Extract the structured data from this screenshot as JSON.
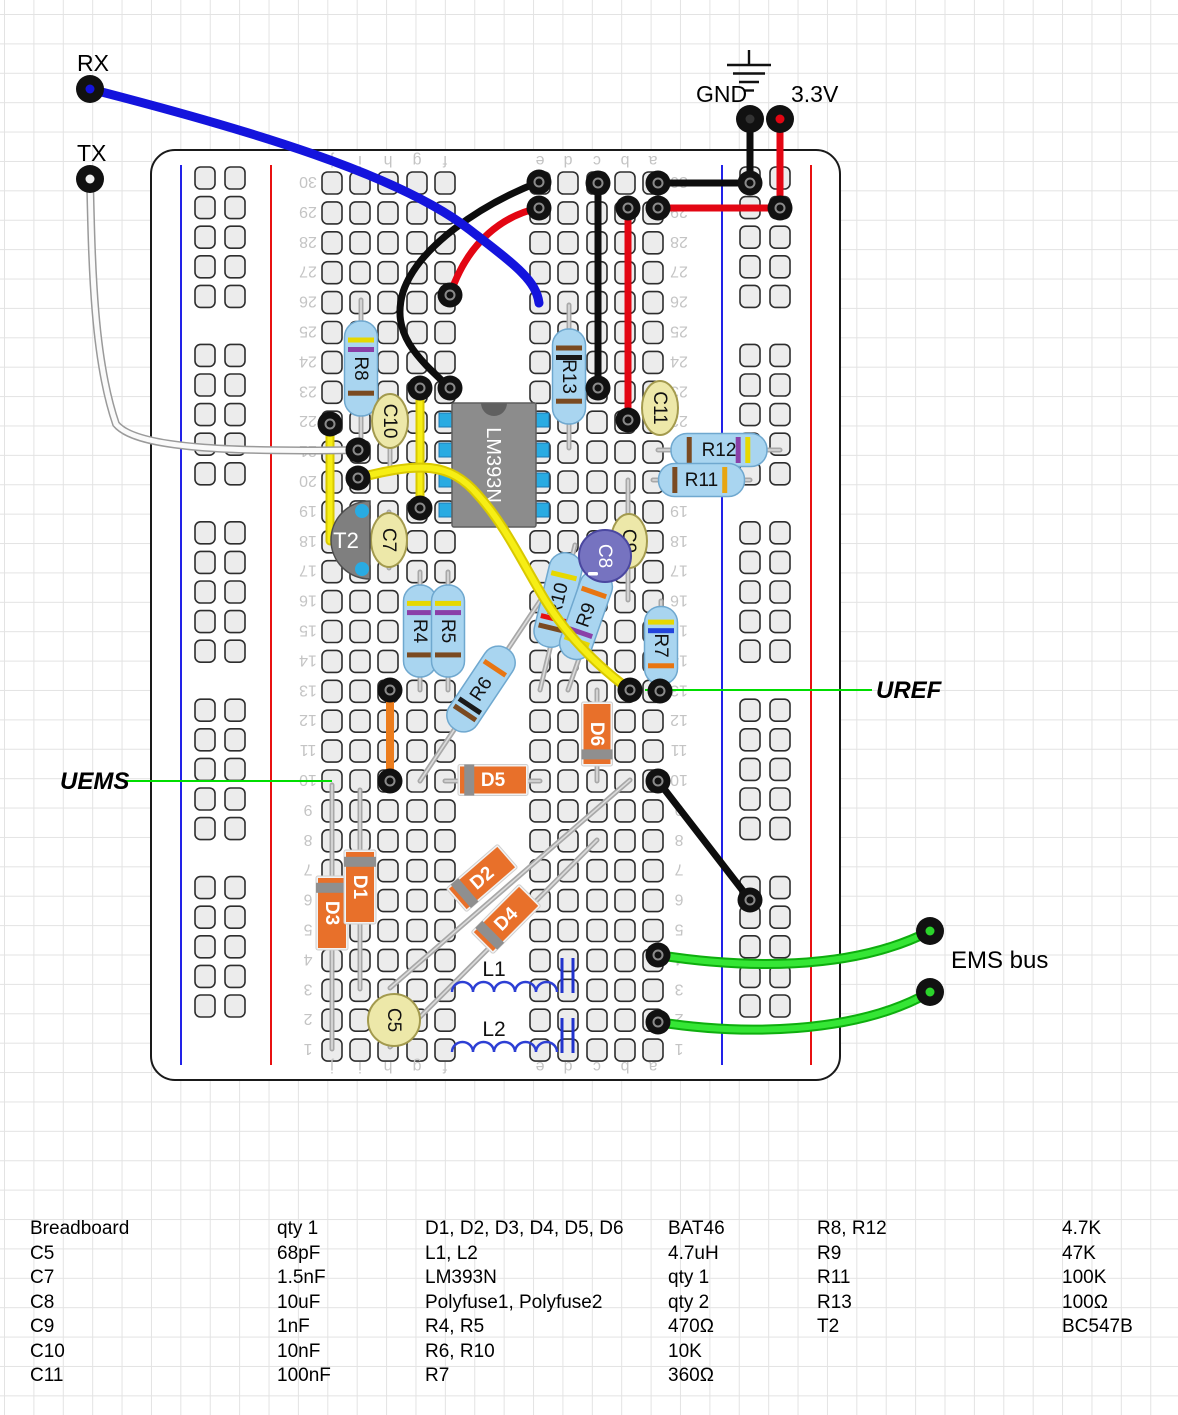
{
  "canvas": {
    "w": 1178,
    "h": 1415
  },
  "labels": {
    "rx": "RX",
    "tx": "TX",
    "gnd": "GND",
    "v33": "3.3V",
    "uref": "UREF",
    "uems": "UEMS",
    "ems_bus": "EMS bus"
  },
  "board": {
    "x": 151,
    "y": 150,
    "w": 689,
    "h": 930,
    "row_count": 30,
    "row0_y": 183,
    "row_pitch": 29.9,
    "cols_left": {
      "letters": [
        "j",
        "i",
        "h",
        "g",
        "f"
      ],
      "x": [
        332,
        360,
        388,
        417,
        445
      ]
    },
    "cols_right": {
      "letters": [
        "e",
        "d",
        "c",
        "b",
        "a"
      ],
      "x": [
        540,
        568,
        597,
        625,
        653
      ]
    },
    "rails": {
      "left": {
        "blue_x": 181,
        "red_x": 271,
        "hole_x": [
          205,
          235
        ]
      },
      "right": {
        "blue_x": 722,
        "red_x": 811,
        "hole_x": [
          750,
          780
        ]
      },
      "line_y1": 165,
      "line_y2": 1065,
      "group_y0": 178,
      "group_pitch": 177.4,
      "hole_pitch": 29.6,
      "holes_per_group": 5,
      "groups": 5
    },
    "num_x_left": 308,
    "num_x_right": 679,
    "letters_y_top": 162,
    "letters_y_bottom": 1068,
    "hole_fill": "#ececec",
    "hole_stroke": "#2e2e2e",
    "rail_blue": "#2222e8",
    "rail_red": "#e81111"
  },
  "callouts": [
    {
      "name": "uems-callout",
      "x1": 123,
      "y1": 781,
      "x2": 332,
      "y2": 781,
      "color": "#00dd00"
    },
    {
      "name": "uref-callout",
      "x1": 645,
      "y1": 690,
      "x2": 872,
      "y2": 690,
      "color": "#00dd00"
    }
  ],
  "components": [
    {
      "id": "D3",
      "type": "diode",
      "label": "D3",
      "a": [
        332,
        785
      ],
      "b": [
        332,
        1049
      ],
      "body": [
        332,
        913
      ],
      "len": 70,
      "wid": 28,
      "band_f": -0.36
    },
    {
      "id": "D1",
      "type": "diode",
      "label": "D1",
      "a": [
        360,
        790
      ],
      "b": [
        360,
        989
      ],
      "body": [
        360,
        887
      ],
      "len": 70,
      "wid": 28,
      "band_f": -0.36
    },
    {
      "id": "D2",
      "type": "diode",
      "label": "D2",
      "a": [
        390,
        988
      ],
      "b": [
        630,
        780
      ],
      "body": [
        482,
        878
      ],
      "len": 64,
      "wid": 27,
      "band_f": -0.36
    },
    {
      "id": "D4",
      "type": "diode",
      "label": "D4",
      "a": [
        390,
        1047
      ],
      "b": [
        597,
        840
      ],
      "body": [
        506,
        919
      ],
      "len": 64,
      "wid": 27,
      "band_f": -0.36
    },
    {
      "id": "C5",
      "type": "cap_round",
      "label": "C5",
      "c": [
        394,
        1020
      ],
      "r": 26,
      "fill": "#EDE8A9",
      "stroke": "#A39A4E",
      "text": "#111"
    },
    {
      "id": "L1",
      "type": "inductor",
      "label": "L1",
      "x1": 452,
      "y": 992,
      "bumps": 5,
      "bump_w": 21,
      "label_pos": [
        494,
        976
      ]
    },
    {
      "id": "L2",
      "type": "inductor",
      "label": "L2",
      "x1": 452,
      "y": 1052,
      "bumps": 5,
      "bump_w": 21,
      "label_pos": [
        494,
        1036
      ]
    },
    {
      "id": "Polyfuse1",
      "type": "polyfuse",
      "x": [
        562,
        573
      ],
      "y1": 958,
      "y2": 993
    },
    {
      "id": "Polyfuse2",
      "type": "polyfuse",
      "x": [
        562,
        573
      ],
      "y1": 1018,
      "y2": 1053
    },
    {
      "id": "D5",
      "type": "diode",
      "label": "D5",
      "a": [
        445,
        781
      ],
      "b": [
        540,
        781
      ],
      "body": [
        493,
        780
      ],
      "len": 66,
      "wid": 27,
      "band_f": -0.36
    },
    {
      "id": "D6",
      "type": "diode",
      "label": "D6",
      "a": [
        597,
        690
      ],
      "b": [
        597,
        781
      ],
      "body": [
        597,
        734
      ],
      "len": 60,
      "wid": 27,
      "band_f": 0.34
    },
    {
      "id": "R8",
      "type": "resistor",
      "label": "R8",
      "a": [
        361,
        300
      ],
      "b": [
        361,
        437
      ],
      "body_len": 95,
      "bands": [
        [
          "#e6d800",
          -0.3
        ],
        [
          "#8a3fa8",
          -0.2
        ],
        [
          "#7a4a21",
          0.26
        ]
      ]
    },
    {
      "id": "R13",
      "type": "resistor",
      "label": "R13",
      "a": [
        569,
        305
      ],
      "b": [
        569,
        448
      ],
      "body_len": 95,
      "bands": [
        [
          "#7a4a21",
          -0.3
        ],
        [
          "#1a1a1a",
          -0.2
        ],
        [
          "#7a4a21",
          0.26
        ]
      ]
    },
    {
      "id": "R4",
      "type": "resistor",
      "label": "R4",
      "a": [
        420,
        572
      ],
      "b": [
        420,
        690
      ],
      "body_len": 92,
      "bands": [
        [
          "#e6d800",
          -0.3
        ],
        [
          "#8a3fa8",
          -0.2
        ],
        [
          "#7a4a21",
          0.26
        ]
      ]
    },
    {
      "id": "R5",
      "type": "resistor",
      "label": "R5",
      "a": [
        448,
        572
      ],
      "b": [
        448,
        690
      ],
      "body_len": 92,
      "bands": [
        [
          "#e6d800",
          -0.3
        ],
        [
          "#8a3fa8",
          -0.2
        ],
        [
          "#7a4a21",
          0.26
        ]
      ]
    },
    {
      "id": "R6",
      "type": "resistor",
      "label": "R6",
      "a": [
        420,
        781
      ],
      "b": [
        540,
        601
      ],
      "body_c": [
        481,
        689
      ],
      "body_len": 96,
      "bands": [
        [
          "#7a4a21",
          -0.3
        ],
        [
          "#1a1a1a",
          -0.21
        ],
        [
          "#e87511",
          0.26
        ]
      ]
    },
    {
      "id": "R10",
      "type": "resistor",
      "label": "R10",
      "a": [
        540,
        690
      ],
      "b": [
        575,
        545
      ],
      "body_c": [
        558,
        600
      ],
      "body_len": 96,
      "bands": [
        [
          "#7a4a21",
          -0.3
        ],
        [
          "#e81111",
          -0.2
        ],
        [
          "#e6d800",
          0.26
        ]
      ]
    },
    {
      "id": "R9",
      "type": "resistor",
      "label": "R9",
      "a": [
        568,
        690
      ],
      "b": [
        610,
        570
      ],
      "body_c": [
        586,
        615
      ],
      "body_len": 92,
      "bands": [
        [
          "#e6d800",
          -0.3
        ],
        [
          "#8a3fa8",
          -0.2
        ],
        [
          "#e87511",
          0.26
        ]
      ]
    },
    {
      "id": "R7",
      "type": "resistor",
      "label": "R7",
      "a": [
        661,
        601
      ],
      "b": [
        661,
        690
      ],
      "body_len": 78,
      "bands": [
        [
          "#e6d800",
          -0.3
        ],
        [
          "#2244dd",
          -0.19
        ],
        [
          "#e87511",
          0.26
        ]
      ]
    },
    {
      "id": "R12",
      "type": "resistor",
      "label": "R12",
      "a": [
        658,
        450
      ],
      "b": [
        780,
        450
      ],
      "body_len": 96,
      "bands": [
        [
          "#7a4a21",
          -0.31
        ],
        [
          "#8a3fa8",
          0.2
        ],
        [
          "#e6d800",
          0.3
        ]
      ]
    },
    {
      "id": "R11",
      "type": "resistor",
      "label": "R11",
      "a": [
        653,
        480
      ],
      "b": [
        750,
        480
      ],
      "body_len": 86,
      "bands": [
        [
          "#7a4a21",
          -0.31
        ],
        [
          "#e8a511",
          0.27
        ]
      ]
    },
    {
      "id": "C10",
      "type": "cap_ellipse",
      "label": "C10",
      "c": [
        390,
        421
      ],
      "lead": [
        390,
        400,
        390,
        472
      ]
    },
    {
      "id": "C7",
      "type": "cap_ellipse",
      "label": "C7",
      "c": [
        389,
        540
      ],
      "lead": [
        389,
        512,
        389,
        568
      ]
    },
    {
      "id": "C9",
      "type": "cap_ellipse",
      "label": "C9",
      "c": [
        629,
        541
      ],
      "lead": [
        628,
        480,
        628,
        600
      ]
    },
    {
      "id": "C11",
      "type": "cap_ellipse",
      "label": "C11",
      "c": [
        660,
        408
      ],
      "lead": [
        660,
        388,
        660,
        430
      ]
    },
    {
      "id": "T2",
      "type": "transistor",
      "label": "T2",
      "cx": 352,
      "cy": 540,
      "r": 39,
      "pins": [
        [
          362,
          511
        ],
        [
          362,
          569
        ]
      ]
    },
    {
      "id": "C8",
      "type": "cap_round",
      "label": "C8",
      "c": [
        605,
        556
      ],
      "r": 26,
      "fill": "#7673c0",
      "stroke": "#4a47a0",
      "text": "#fff",
      "minus": true
    },
    {
      "id": "IC1",
      "type": "ic",
      "label": "LM393N",
      "x": 452,
      "y": 403,
      "w": 84,
      "h": 124,
      "pad_rows": [
        420,
        450,
        480,
        510
      ],
      "pad_lx": 448,
      "pad_rx": 540
    }
  ],
  "under_wires": [
    {
      "name": "yellow-jumper-left",
      "colors": [
        "#d9c900",
        "#f6ee15"
      ],
      "widths": [
        9,
        5
      ],
      "path": "M330,424 L330,541"
    }
  ],
  "wires": [
    {
      "name": "red-curve-top",
      "colors": [
        "#e30613"
      ],
      "widths": [
        7
      ],
      "path": "M539,208 C505,215 468,240 450,295"
    },
    {
      "name": "black-curve-top",
      "colors": [
        "#0d0d0d"
      ],
      "widths": [
        7
      ],
      "path": "M539,182 C480,205 418,247 403,292 C391,333 416,357 450,388"
    },
    {
      "name": "rx-wire-blue",
      "colors": [
        "#1414dd"
      ],
      "widths": [
        9
      ],
      "path": "M90,89 C250,130 400,175 470,230 C515,265 536,280 539,303"
    },
    {
      "name": "tx-wire-white",
      "colors": [
        "#9a9a9a",
        "#fafafa"
      ],
      "widths": [
        8,
        5
      ],
      "path": "M90,179 C92,270 94,360 116,424 C136,449 235,452 358,450"
    },
    {
      "name": "gnd-stub",
      "colors": [
        "#0d0d0d"
      ],
      "widths": [
        7
      ],
      "path": "M750,118 L750,183"
    },
    {
      "name": "v33-stub",
      "colors": [
        "#e30613"
      ],
      "widths": [
        7
      ],
      "path": "M780,118 L780,208"
    },
    {
      "name": "row30-black",
      "colors": [
        "#0d0d0d"
      ],
      "widths": [
        7
      ],
      "path": "M658,183 L750,183"
    },
    {
      "name": "row29-red",
      "colors": [
        "#e30613"
      ],
      "widths": [
        7
      ],
      "path": "M658,208 L780,208"
    },
    {
      "name": "vertical-black",
      "colors": [
        "#0d0d0d"
      ],
      "widths": [
        7
      ],
      "path": "M598,183 L598,388"
    },
    {
      "name": "vertical-red",
      "colors": [
        "#e30613"
      ],
      "widths": [
        7
      ],
      "path": "M628,208 L628,420"
    },
    {
      "name": "yellow-jumper-mid",
      "colors": [
        "#d9c900",
        "#f6ee15"
      ],
      "widths": [
        9,
        5
      ],
      "path": "M420,388 L420,508"
    },
    {
      "name": "orange-jumper",
      "colors": [
        "#ec7d1d"
      ],
      "widths": [
        8
      ],
      "path": "M390,690 L390,781"
    },
    {
      "name": "yellow-long",
      "colors": [
        "#d9c900",
        "#f6ee15"
      ],
      "widths": [
        10,
        6
      ],
      "path": "M358,478 C420,462 450,462 478,495 C505,525 522,562 545,600 C570,640 600,668 630,690"
    },
    {
      "name": "black-diagonal",
      "colors": [
        "#0d0d0d"
      ],
      "widths": [
        7
      ],
      "path": "M658,781 L750,900"
    },
    {
      "name": "ems-wire-1",
      "colors": [
        "#0eae0e",
        "#35e635"
      ],
      "widths": [
        10,
        6
      ],
      "path": "M658,955 C740,968 850,972 930,931"
    },
    {
      "name": "ems-wire-2",
      "colors": [
        "#0eae0e",
        "#35e635"
      ],
      "widths": [
        10,
        6
      ],
      "path": "M658,1022 C740,1035 855,1035 930,992"
    }
  ],
  "dots": [
    [
      539,
      182
    ],
    [
      539,
      208
    ],
    [
      450,
      295
    ],
    [
      450,
      388
    ],
    [
      420,
      388
    ],
    [
      420,
      508
    ],
    [
      330,
      424
    ],
    [
      358,
      450
    ],
    [
      358,
      478
    ],
    [
      598,
      183
    ],
    [
      598,
      388
    ],
    [
      628,
      208
    ],
    [
      628,
      420
    ],
    [
      658,
      183
    ],
    [
      658,
      208
    ],
    [
      750,
      183
    ],
    [
      780,
      208
    ],
    [
      390,
      690
    ],
    [
      390,
      781
    ],
    [
      630,
      690
    ],
    [
      660,
      691
    ],
    [
      658,
      781
    ],
    [
      750,
      900
    ],
    [
      658,
      955
    ],
    [
      658,
      1022
    ]
  ],
  "pins": [
    {
      "name": "rx-pin",
      "x": 90,
      "y": 89,
      "core": "#1414dd"
    },
    {
      "name": "tx-pin",
      "x": 90,
      "y": 179,
      "core": "#f0f0f0"
    },
    {
      "name": "gnd-pin",
      "x": 750,
      "y": 119,
      "core": "#333333"
    },
    {
      "name": "v33-pin",
      "x": 780,
      "y": 119,
      "core": "#e30613"
    },
    {
      "name": "ems-pin-1",
      "x": 930,
      "y": 931,
      "core": "#2bd42b"
    },
    {
      "name": "ems-pin-2",
      "x": 930,
      "y": 992,
      "core": "#2bd42b"
    }
  ],
  "gnd_symbol": {
    "stem": [
      749,
      50,
      749,
      65
    ],
    "lines": [
      [
        727,
        65,
        771,
        65
      ],
      [
        733,
        73.5,
        765,
        73.5
      ],
      [
        739,
        82,
        759,
        82
      ],
      [
        744,
        90.5,
        754,
        90.5
      ]
    ]
  },
  "parts_table": {
    "col_x": [
      30,
      277,
      425,
      668,
      817,
      1062
    ],
    "row_top0": 1218,
    "row_pitch": 24.5,
    "rows": [
      [
        "Breadboard",
        "qty 1",
        "D1, D2, D3, D4, D5, D6",
        "BAT46",
        "R8, R12",
        "4.7K"
      ],
      [
        "C5",
        "68pF",
        "L1, L2",
        "4.7uH",
        "R9",
        "47K"
      ],
      [
        "C7",
        "1.5nF",
        "LM393N",
        "qty 1",
        "R11",
        "100K"
      ],
      [
        "C8",
        "10uF",
        "Polyfuse1, Polyfuse2",
        "qty 2",
        "R13",
        "100Ω"
      ],
      [
        "C9",
        "1nF",
        "R4, R5",
        "470Ω",
        "T2",
        "BC547B"
      ],
      [
        "C10",
        "10nF",
        "R6, R10",
        "10K",
        "",
        ""
      ],
      [
        "C11",
        "100nF",
        "R7",
        "360Ω",
        "",
        ""
      ]
    ]
  }
}
